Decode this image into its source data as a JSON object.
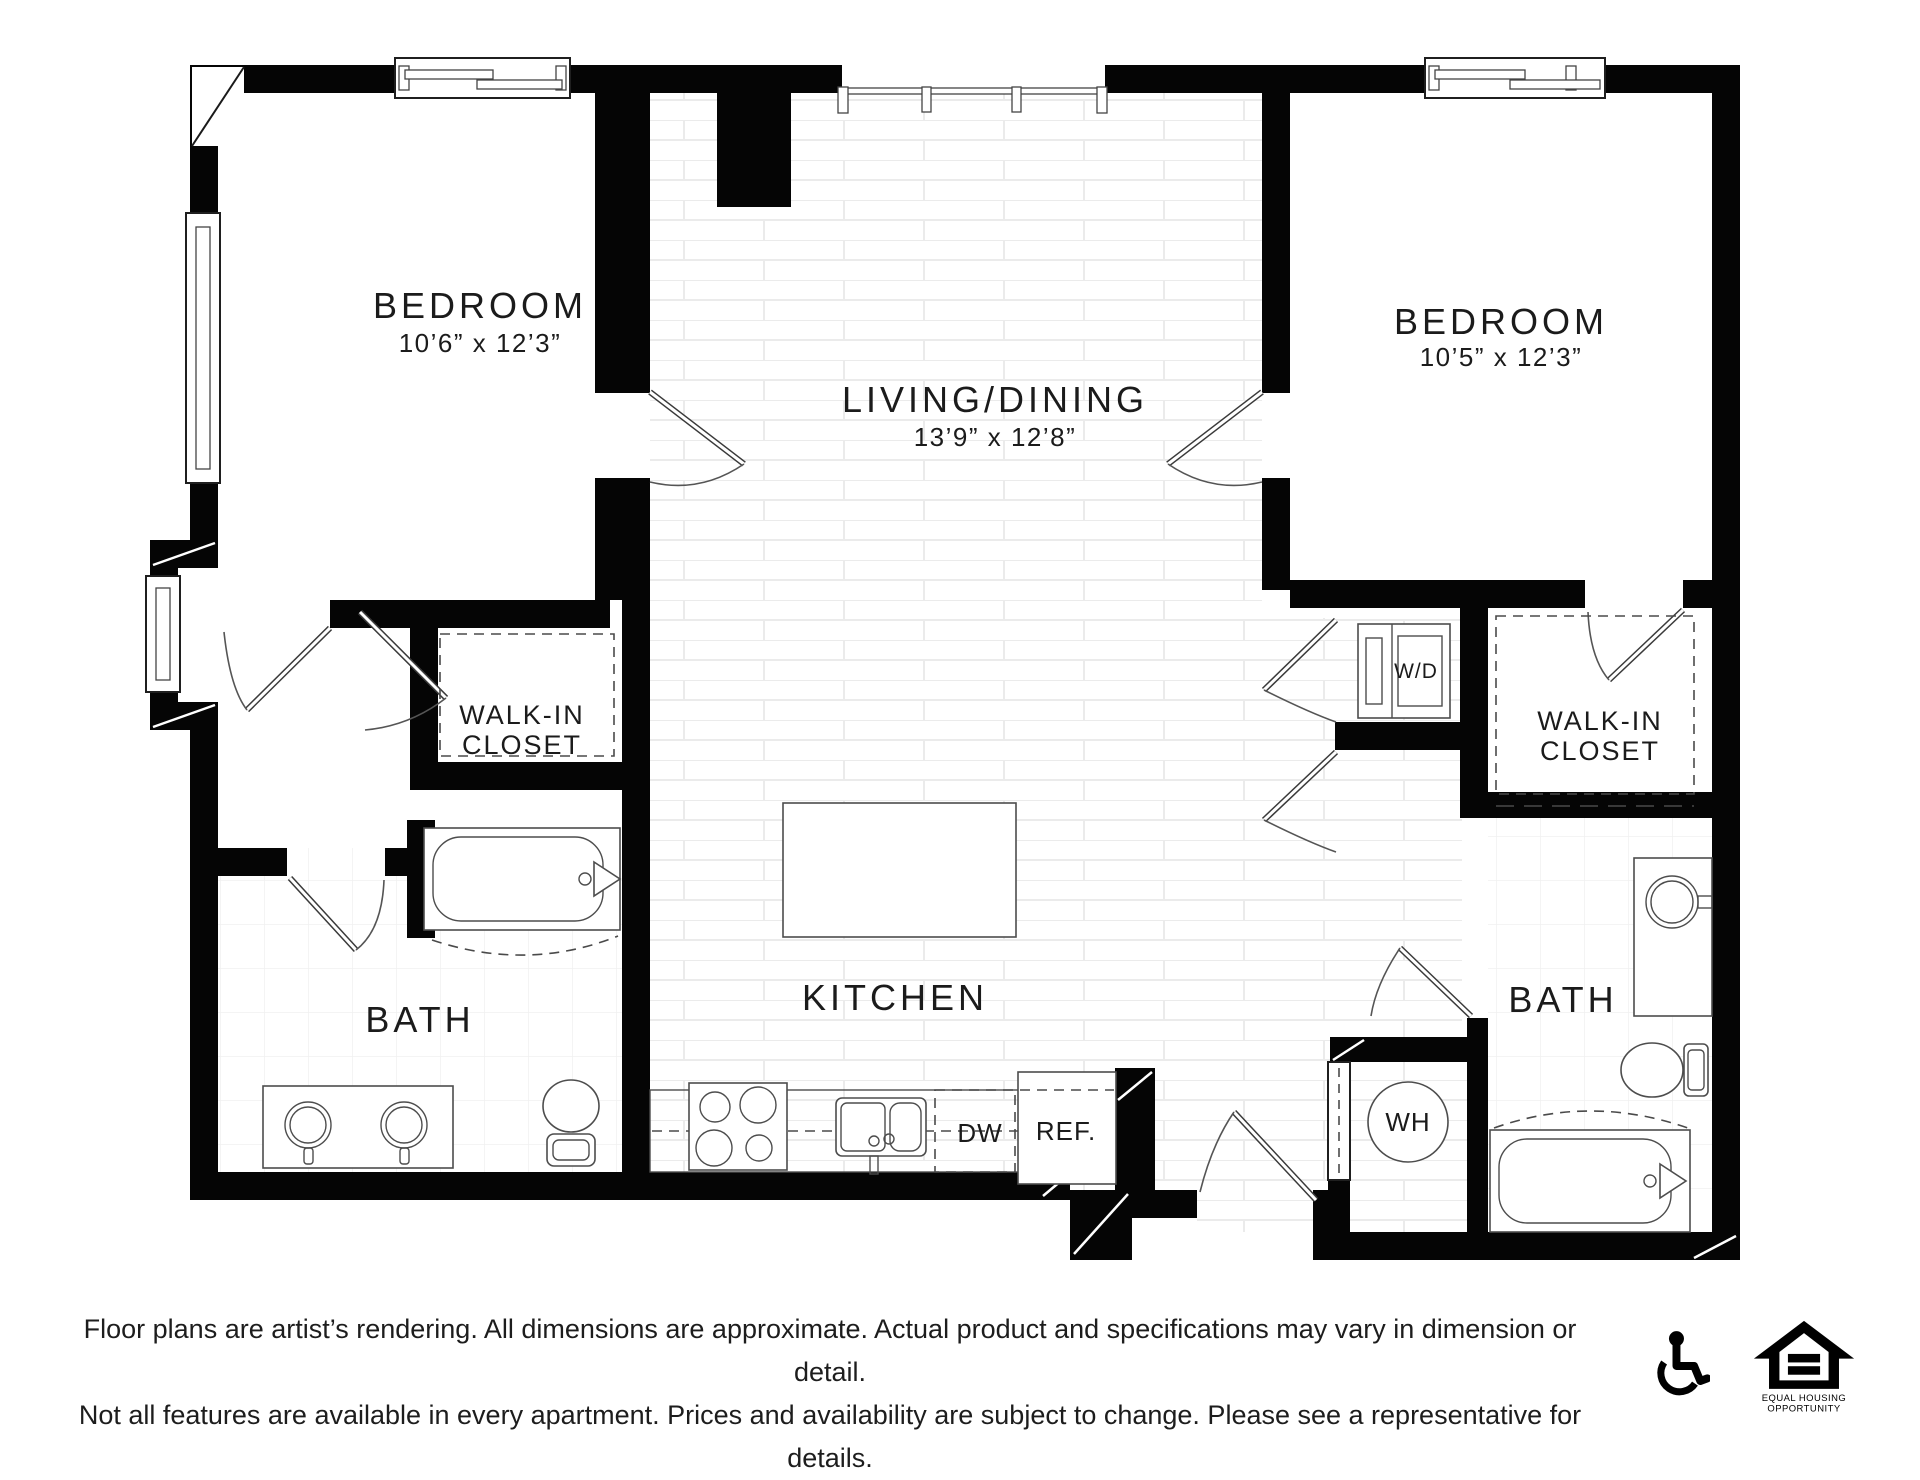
{
  "plan": {
    "bedroom_left": {
      "label": "BEDROOM",
      "dims": "10’6” x 12’3”"
    },
    "bedroom_right": {
      "label": "BEDROOM",
      "dims": "10’5” x 12’3”"
    },
    "living_dining": {
      "label": "LIVING/DINING",
      "dims": "13’9” x 12’8”"
    },
    "closet_left": {
      "line1": "WALK-IN",
      "line2": "CLOSET"
    },
    "closet_right": {
      "line1": "WALK-IN",
      "line2": "CLOSET"
    },
    "bath_left": {
      "label": "BATH"
    },
    "bath_right": {
      "label": "BATH"
    },
    "kitchen": {
      "label": "KITCHEN"
    },
    "washer_dryer": {
      "label": "W/D"
    },
    "water_heater": {
      "label": "WH"
    },
    "dishwasher": {
      "label": "DW"
    },
    "refrigerator": {
      "label": "REF."
    }
  },
  "footer": {
    "disclaimer_line1": "Floor plans are artist’s rendering. All dimensions are approximate. Actual product and specifications may vary in dimension or detail.",
    "disclaimer_line2": "Not all features are available in every apartment. Prices and availability are subject to change. Please see a representative for details.",
    "equal_housing_line1": "EQUAL HOUSING",
    "equal_housing_line2": "OPPORTUNITY"
  },
  "colors": {
    "wall": "#000000",
    "fixture_line": "#4d4d4d",
    "text": "#1b1b1b"
  }
}
